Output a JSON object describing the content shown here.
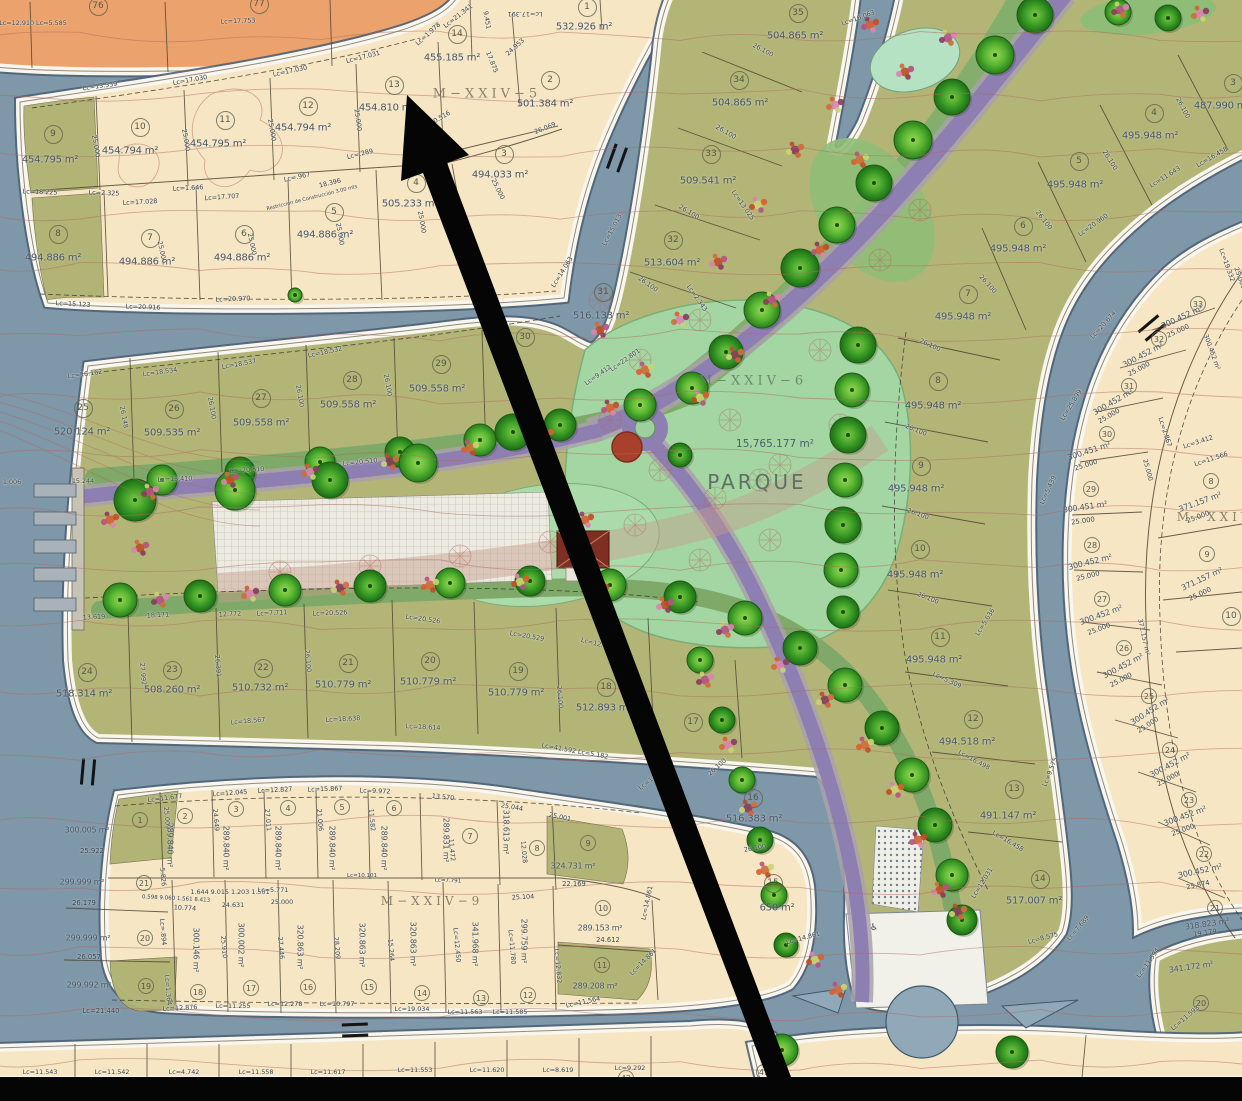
{
  "map": {
    "park": {
      "label": "PARQUE",
      "area": "15,765.177 m²"
    },
    "block_labels": [
      "M−XXIV−5",
      "M−XXIV−6",
      "M−XXIV−7",
      "M−XXIV−9"
    ],
    "icons": {
      "accessibility": "♿"
    },
    "colors": {
      "water": "#7E97A9",
      "bank_white": "#F8F6EE",
      "cream_lot": "#F7E6C3",
      "olive_lot": "#B3B577",
      "orange_lot": "#ECA26C",
      "park_green": "#A3D6A2",
      "road_purple": "#8D7FB2",
      "contour_red": "#B06A5E",
      "annotation": "#050505"
    },
    "parcels": [
      {
        "b": "M5",
        "n": "9",
        "a": "454.795 m²"
      },
      {
        "b": "M5",
        "n": "10",
        "a": "454.794 m²"
      },
      {
        "b": "M5",
        "n": "11",
        "a": "454.795 m²"
      },
      {
        "b": "M5",
        "n": "12",
        "a": "454.794 m²"
      },
      {
        "b": "M5",
        "n": "13",
        "a": "454.810 m²"
      },
      {
        "b": "M5",
        "n": "14",
        "a": "455.185 m²"
      },
      {
        "b": "M5",
        "n": "2",
        "a": "501.384 m²"
      },
      {
        "b": "M5",
        "n": "3",
        "a": "494.033 m²"
      },
      {
        "b": "M5",
        "n": "4",
        "a": "505.233 m²"
      },
      {
        "b": "M5",
        "n": "5",
        "a": "494.886 m²"
      },
      {
        "b": "M5",
        "n": "6",
        "a": "494.886 m²"
      },
      {
        "b": "M5",
        "n": "7",
        "a": "494.886 m²"
      },
      {
        "b": "M5",
        "n": "8",
        "a": "494.886 m²"
      },
      {
        "b": "C",
        "n": "25",
        "a": "520.124 m²"
      },
      {
        "b": "C",
        "n": "26",
        "a": "509.535 m²"
      },
      {
        "b": "C",
        "n": "27",
        "a": "509.558 m²"
      },
      {
        "b": "C",
        "n": "28",
        "a": "509.558 m²"
      },
      {
        "b": "C",
        "n": "29",
        "a": "509.558 m²"
      },
      {
        "b": "C",
        "n": "30",
        "a": ""
      },
      {
        "b": "C",
        "n": "24",
        "a": "518.314 m²"
      },
      {
        "b": "C",
        "n": "23",
        "a": "508.260 m²"
      },
      {
        "b": "C",
        "n": "22",
        "a": "510.732 m²"
      },
      {
        "b": "C",
        "n": "21",
        "a": "510.779 m²"
      },
      {
        "b": "C",
        "n": "20",
        "a": "510.779 m²"
      },
      {
        "b": "C",
        "n": "19",
        "a": "510.779 m²"
      },
      {
        "b": "C",
        "n": "18",
        "a": "512.893 m²"
      },
      {
        "b": "C",
        "n": "17",
        "a": ""
      },
      {
        "b": "C",
        "n": "16",
        "a": "516.383 m²"
      },
      {
        "b": "C",
        "n": "15",
        "a": "650 m²"
      },
      {
        "b": "M6",
        "n": "1",
        "a": "532.926 m²"
      },
      {
        "b": "M6",
        "n": "35",
        "a": "504.865 m²"
      },
      {
        "b": "M6",
        "n": "34",
        "a": "504.865 m²"
      },
      {
        "b": "M6",
        "n": "33",
        "a": "509.541 m²"
      },
      {
        "b": "M6",
        "n": "32",
        "a": "513.604 m²"
      },
      {
        "b": "M6",
        "n": "31",
        "a": "516.133 m²"
      },
      {
        "b": "M6",
        "n": "3",
        "a": "487.990 m²"
      },
      {
        "b": "M6",
        "n": "4",
        "a": "495.948 m²"
      },
      {
        "b": "M6",
        "n": "5",
        "a": "495.948 m²"
      },
      {
        "b": "M6",
        "n": "6",
        "a": "495.948 m²"
      },
      {
        "b": "M6",
        "n": "7",
        "a": "495.948 m²"
      },
      {
        "b": "M6",
        "n": "8",
        "a": "495.948 m²"
      },
      {
        "b": "M6",
        "n": "9",
        "a": "495.948 m²"
      },
      {
        "b": "M6",
        "n": "10",
        "a": "495.948 m²"
      },
      {
        "b": "M6",
        "n": "11",
        "a": "495.948 m²"
      },
      {
        "b": "M6",
        "n": "12",
        "a": "494.518 m²"
      },
      {
        "b": "M6",
        "n": "13",
        "a": "491.147 m²"
      },
      {
        "b": "M6",
        "n": "14",
        "a": "517.007 m²"
      },
      {
        "b": "M7",
        "n": "33",
        "a": "300.452 m²",
        "s": "25.000"
      },
      {
        "b": "M7",
        "n": "32",
        "a": "300.452 m²",
        "s": "25.000"
      },
      {
        "b": "M7",
        "n": "31",
        "a": "300.452 m²",
        "s": "25.000"
      },
      {
        "b": "M7",
        "n": "30",
        "a": "300.451 m²",
        "s": "25.000"
      },
      {
        "b": "M7",
        "n": "29",
        "a": "300.451 m²",
        "s": "25.000"
      },
      {
        "b": "M7",
        "n": "28",
        "a": "300.452 m²",
        "s": "25.000"
      },
      {
        "b": "M7",
        "n": "27",
        "a": "300.452 m²",
        "s": "25.000"
      },
      {
        "b": "M7",
        "n": "26",
        "a": "300.452 m²",
        "s": "25.000"
      },
      {
        "b": "M7",
        "n": "25",
        "a": "300.452 m²",
        "s": "25.000"
      },
      {
        "b": "M7",
        "n": "24",
        "a": "300.452 m²",
        "s": "25.000"
      },
      {
        "b": "M7",
        "n": "23",
        "a": "300.452 m²",
        "s": "25.000"
      },
      {
        "b": "M7",
        "n": "22",
        "a": "300.452 m²",
        "s": "25.874"
      },
      {
        "b": "M7",
        "n": "21",
        "a": "318.823 m²",
        "s": "19.179"
      },
      {
        "b": "M7",
        "n": "20",
        "a": "341.172 m²"
      },
      {
        "b": "M7",
        "n": "8",
        "a": "371.157 m²",
        "s": "25.000"
      },
      {
        "b": "M7",
        "n": "9",
        "a": "371.157 m²",
        "s": "25.000"
      },
      {
        "b": "M7",
        "n": "10",
        "a": ""
      },
      {
        "b": "M9",
        "n": "1",
        "a": "300.005 m²",
        "s": "25.922"
      },
      {
        "b": "M9",
        "n": "2",
        "a": "289.840 m²"
      },
      {
        "b": "M9",
        "n": "3",
        "a": "289.840 m²"
      },
      {
        "b": "M9",
        "n": "4",
        "a": "289.840 m²"
      },
      {
        "b": "M9",
        "n": "5",
        "a": "289.840 m²"
      },
      {
        "b": "M9",
        "n": "6",
        "a": "289.840 m²"
      },
      {
        "b": "M9",
        "n": "7",
        "a": "289.831 m²"
      },
      {
        "b": "M9",
        "n": "8",
        "a": "318.613 m²"
      },
      {
        "b": "M9",
        "n": "9",
        "a": "324.731 m²",
        "s": "22.169"
      },
      {
        "b": "M9",
        "n": "21",
        "a": "299.999 m²",
        "s": "26.179"
      },
      {
        "b": "M9",
        "n": "20",
        "a": "299.999 m²",
        "s": "26.057"
      },
      {
        "b": "M9",
        "n": "19",
        "a": "299.992 m²",
        "s": "Lc=21.440"
      },
      {
        "b": "M9",
        "n": "18",
        "a": "300.146 m²"
      },
      {
        "b": "M9",
        "n": "17",
        "a": "300.002 m²"
      },
      {
        "b": "M9",
        "n": "16",
        "a": "320.863 m²"
      },
      {
        "b": "M9",
        "n": "15",
        "a": "320.863 m²"
      },
      {
        "b": "M9",
        "n": "14",
        "a": "320.863 m²"
      },
      {
        "b": "M9",
        "n": "13",
        "a": "341.968 m²"
      },
      {
        "b": "M9",
        "n": "12",
        "a": "299.759 m²"
      },
      {
        "b": "M9",
        "n": "10",
        "a": "289.153 m²",
        "s": "24.612"
      },
      {
        "b": "M9",
        "n": "11",
        "a": "289.208 m²"
      },
      {
        "b": "TS",
        "n": "76",
        "a": ""
      },
      {
        "b": "TS",
        "n": "77",
        "a": ""
      },
      {
        "b": "BS",
        "n": "41",
        "a": ""
      },
      {
        "b": "BS",
        "n": "42",
        "a": ""
      }
    ],
    "edge_labels": [
      "Lc=12.910  Lc=5.585",
      "Lc=17.753",
      "Lc=17.391",
      "Lc=13.539",
      "Lc=17.030",
      "Lc=17.030",
      "Lc=17.031",
      "Lc=1.978",
      "Lc=21.341",
      "9.451",
      "24.953",
      "10.516",
      "17.875",
      "26.069",
      "25.000",
      "Lc=.967",
      "18.396",
      "Lc=.289",
      "Lc=18.225",
      "Lc=2.325",
      "Lc=1.646",
      "Lc=17.028",
      "Lc=17.707",
      "Restricción de Construcción 3.00 mts",
      "25.000",
      "25.000",
      "25.000",
      "25.000",
      "25.000",
      "25.000",
      "25.000",
      "25.000",
      "Lc=15.123",
      "Lc=20.916",
      "Lc=20.970",
      "Lc=16.162",
      "Lc=18.534",
      "Lc=18.537",
      "Lc=18.532",
      "26.148",
      "26.100",
      "26.100",
      "26.100",
      "Lc=20.510",
      "Lc=20.510",
      "Lc=15.410",
      "15.244",
      "1.006",
      "13.619",
      "18.171",
      "12.772",
      "Lc=7.711",
      "Lc=20.526",
      "Lc=20.526",
      "Lc=20.529",
      "Lc=12.784",
      "27.992",
      "26.391",
      "26.100",
      "26.100",
      "Lc=18.567",
      "Lc=18.638",
      "Lc=18.614",
      "Lc=41.592  Lc=5.182",
      "Lc=13.734",
      "26.100",
      "26.100",
      "Lc=15.013",
      "Lc=14.063",
      "Lc=13.025",
      "Lc=2.343",
      "Lc=22.801",
      "Lc=9.412",
      "Lc=16.063",
      "26.100",
      "26.100",
      "26.100",
      "26.100",
      "26.100",
      "26.100",
      "26.100",
      "26.100",
      "26.100",
      "26.100",
      "26.100",
      "26.100",
      "Lc=5.309",
      "Lc=16.498",
      "Lc=16.458",
      "Lc=16.458",
      "Lc=11.643",
      "Lc=20.960",
      "Lc=5.636",
      "Lc=12.031",
      "Lc=14.861",
      "Lc=14.861",
      "Lc=14.861",
      "Lc=20.674",
      "Lc=25.899",
      "Lc=5.439",
      "Lc=9.575",
      "Lc=7.689",
      "Lc=8.575",
      "Lc=2.867",
      "25.000",
      "300.452 m²",
      "371.157 m²",
      "25.000",
      "Lc=19.332",
      "Lc=3.412",
      "Lc=11.566",
      "Lc=11.593",
      "Lc=11.594",
      "Lc=11.677",
      "Lc=12.045",
      "Lc=12.827",
      "Lc=15.867",
      "Lc=9.972",
      "13.570",
      "25.044",
      "25.001",
      "25.009",
      "24.649",
      "27.011",
      "21.006",
      "11.582",
      "11.472",
      "12.028",
      "5.826",
      "Lc=.894",
      "Lc=1.364",
      "0.598 9.060 1.561 8.413",
      "1.644 9.015 1.203 1.501",
      "Lc=5.771",
      "Lc=10.101",
      "Lc=7.791",
      "10.774",
      "24.631",
      "25.000",
      "25.104",
      "25.910",
      "27.446",
      "28.209",
      "15.264",
      "Lc=12.450",
      "Lc=11.780",
      "Lc=12.832",
      "Lc=12.876",
      "Lc=11.255",
      "Lc=12.278",
      "Lc=10.797",
      "Lc=19.034",
      "Lc=11.563",
      "Lc=11.585",
      "Lc=11.564",
      "Lc=11.543",
      "Lc=11.542",
      "Lc=4.742",
      "Lc=11.558",
      "Lc=11.617",
      "Lc=11.553",
      "Lc=11.620",
      "Lc=8.619",
      "Lc=9.292"
    ]
  }
}
